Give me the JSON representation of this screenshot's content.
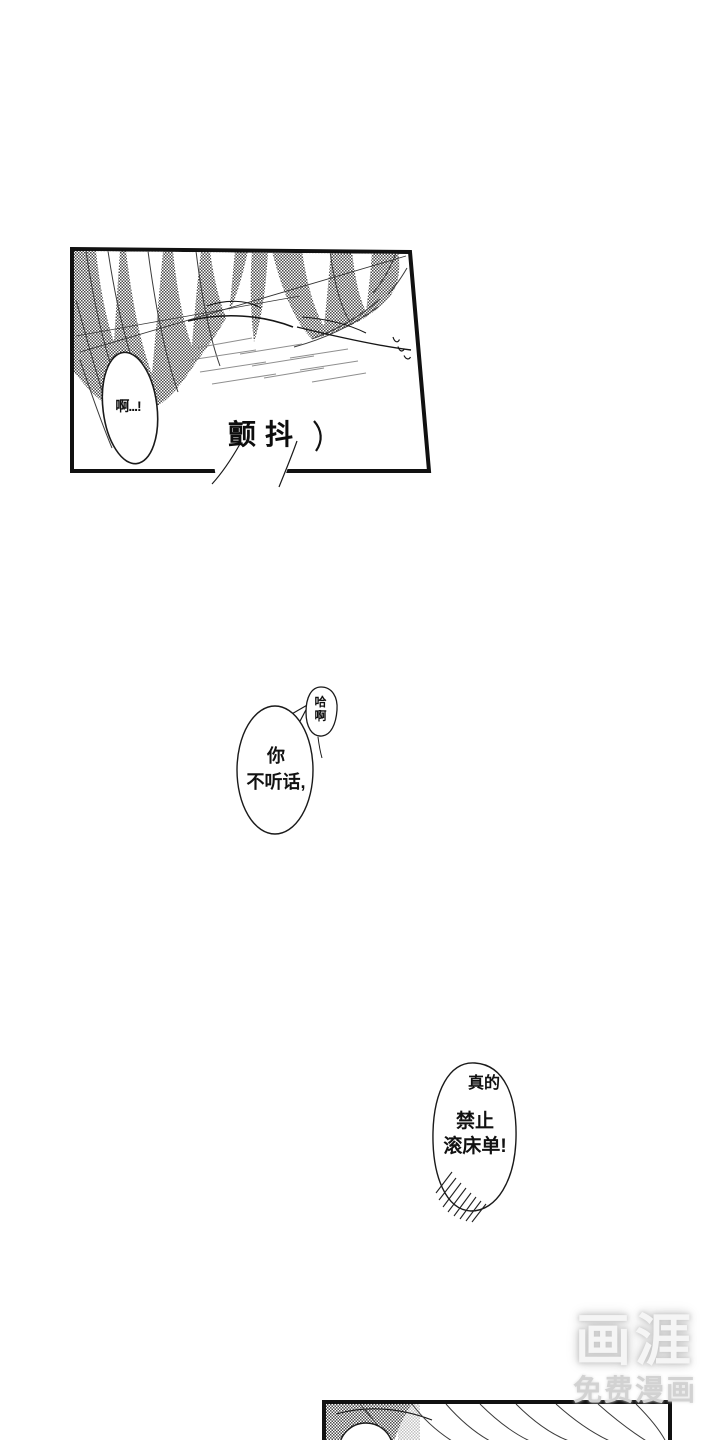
{
  "colors": {
    "background": "#ffffff",
    "panel_border": "#111111",
    "text": "#111111",
    "screentone_gray": "#4a4a4a",
    "blush_line_gray": "#8f8f8f",
    "watermark_gray": "#d2d2d2"
  },
  "top_panel": {
    "sfx_text": "颤抖",
    "bubble_text": "啊...!"
  },
  "middle_bubble": {
    "small_bubble_text": "哈啊",
    "line1": "你",
    "line2": "不听话,"
  },
  "bottom_bubble": {
    "line1": "真的",
    "line2": "禁止",
    "line3": "滚床单!"
  },
  "watermark": {
    "logo": "画涯",
    "tagline": "免费漫画"
  }
}
